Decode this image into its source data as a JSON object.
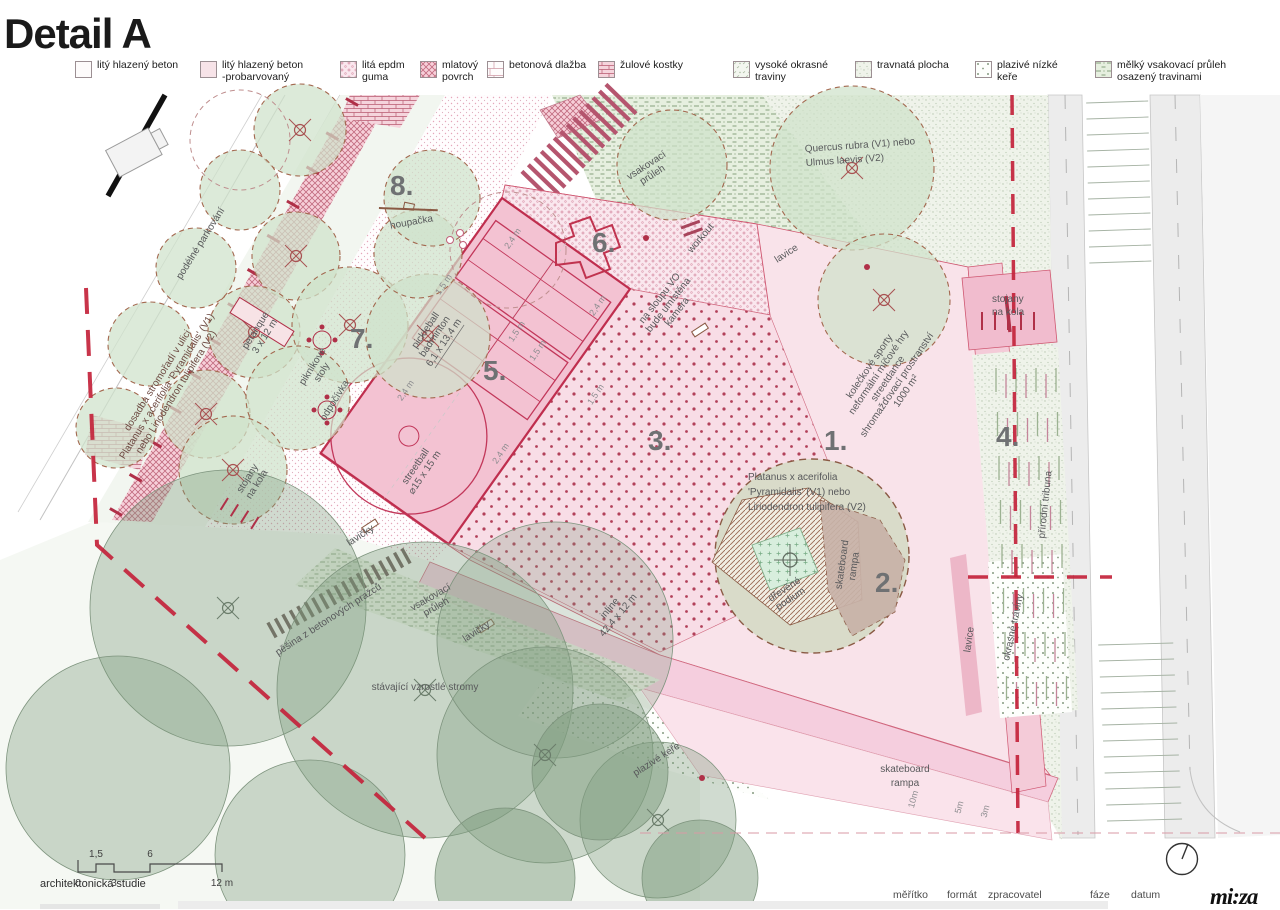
{
  "title": "Detail A",
  "legend": {
    "items": [
      {
        "l1": "litý hlazený beton",
        "l2": ""
      },
      {
        "l1": "litý hlazený beton",
        "l2": "-probarvovaný"
      },
      {
        "l1": "litá epdm",
        "l2": "guma"
      },
      {
        "l1": "mlatový",
        "l2": "povrch"
      },
      {
        "l1": "betonová dlažba",
        "l2": ""
      },
      {
        "l1": "žulové kostky",
        "l2": ""
      },
      {
        "l1": "vysoké okrasné",
        "l2": "traviny"
      },
      {
        "l1": "travnatá plocha",
        "l2": ""
      },
      {
        "l1": "plazivé nízké",
        "l2": "keře"
      },
      {
        "l1": "mělký vsakovací průleh",
        "l2": "osazený travinami"
      }
    ]
  },
  "numbers": {
    "n1": "1.",
    "n2": "2.",
    "n3": "3.",
    "n4": "4.",
    "n5": "5.",
    "n6": "6.",
    "n7": "7.",
    "n8": "8."
  },
  "labels": {
    "vsak": [
      "vsakovací",
      "průleh"
    ],
    "houp": [
      "houpačka"
    ],
    "work": [
      "workout"
    ],
    "kam": [
      "na sloupu VO",
      "bude umístěna",
      "kamera"
    ],
    "lav": [
      "lavice"
    ],
    "quer": [
      "Quercus rubra (V1) nebo",
      "Ulmus laevis (V2)"
    ],
    "dosadba": [
      "dosadba stromořadí v ulici",
      "Platanus x acerifolia 'Pyramidalis' (V1)",
      "nebo Liriodendron tulipifera (V2)"
    ],
    "podelne": [
      "podélné parkování"
    ],
    "petanque": [
      "petanque",
      "3 x 12 m"
    ],
    "piknik": [
      "piknikové",
      "stoly"
    ],
    "odpoc": [
      "odpočívka"
    ],
    "stojany": [
      "stojany",
      "na kola"
    ],
    "pick": [
      "pickleball",
      "badminton",
      "6,1 x 13,4 m"
    ],
    "street": [
      "streetball",
      "⌀15 x 15 m"
    ],
    "d15": "1,5 m",
    "d24": "2,4 m",
    "lavicky": "lavičky",
    "pesina": [
      "pěšina z betonových pražců"
    ],
    "stav": [
      "stávající vzrostlé stromy"
    ],
    "plaz": [
      "plazivé keře"
    ],
    "inline": [
      "inline",
      "42,4 x 12 m"
    ],
    "kolo": [
      "kolečkové sporty",
      "neformální míčové hry",
      "streetdance",
      "shromažďovací prostranství",
      "1000 m²"
    ],
    "plat": [
      "Platanus x acerifolia",
      "'Pyramidalis'  (V1) nebo",
      "Liriodendron tulipifera (V2)"
    ],
    "drev": [
      "dřevěné",
      "podium"
    ],
    "skate": [
      "skateboard",
      "rampa"
    ],
    "d10": "10m",
    "d5": "5m",
    "d3": "3m",
    "okras": [
      "okrasné traviny"
    ],
    "prir": [
      "přírodní tribuna"
    ]
  },
  "scalebar": {
    "t15": "1,5",
    "t6": "6",
    "b0": "0",
    "b3": "3",
    "b12": "12 m"
  },
  "footer": {
    "study": "architektonická studie",
    "meritko": "měřítko",
    "format": "formát",
    "zpracovatel": "zpracovatel",
    "faze": "fáze",
    "datum": "datum",
    "logo": "mi:za"
  },
  "colors": {
    "accent_red": "#c3233b",
    "plaza_pink": "#f9e3ea",
    "court_pink": "#f3c2d2",
    "lawn_green": "#eff3ea",
    "pruleh_green": "#e6efdf",
    "number_gray": "#6f7173"
  }
}
